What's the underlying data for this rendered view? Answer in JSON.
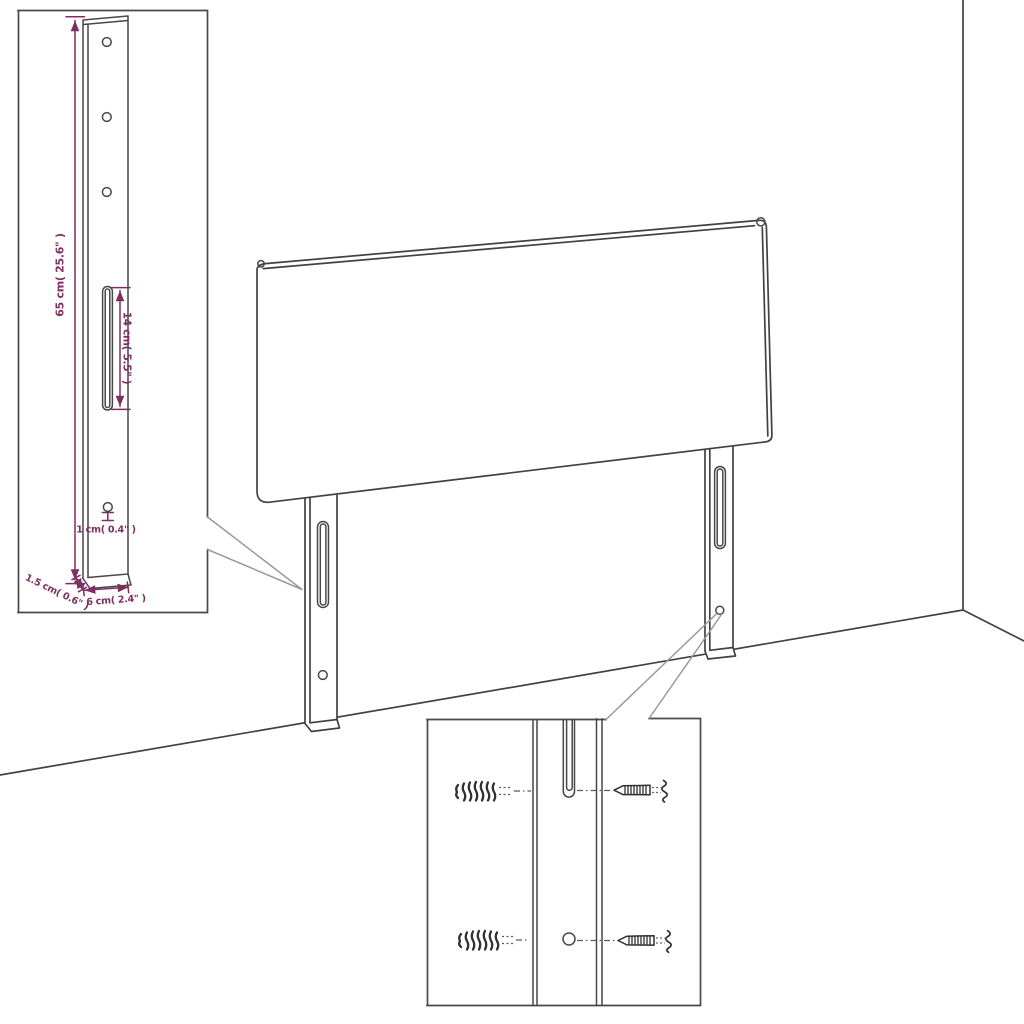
{
  "diagram": {
    "type": "assembly-instruction-illustration",
    "subject": "bed headboard with two mounting legs shown against a room corner",
    "background_color": "#ffffff",
    "outline_color": "#424242",
    "callout_line_color": "#9a9a9a",
    "dimension_color": "#7e2f62"
  },
  "leg_detail_inset": {
    "name": "leg dimension detail",
    "dimensions": {
      "leg_height": "65 cm( 25.6\" )",
      "slot_length": "14 cm( 5.5\" )",
      "hole_diameter": "1 cm( 0.4\" )",
      "leg_thickness": "1.5 cm( 0.6\" )",
      "leg_width": "6 cm( 2.4\" )"
    }
  },
  "mounting_detail_inset": {
    "name": "wall plug and screw mounting detail",
    "hardware": [
      "wall-plug",
      "screw",
      "wall-plug",
      "screw"
    ]
  }
}
